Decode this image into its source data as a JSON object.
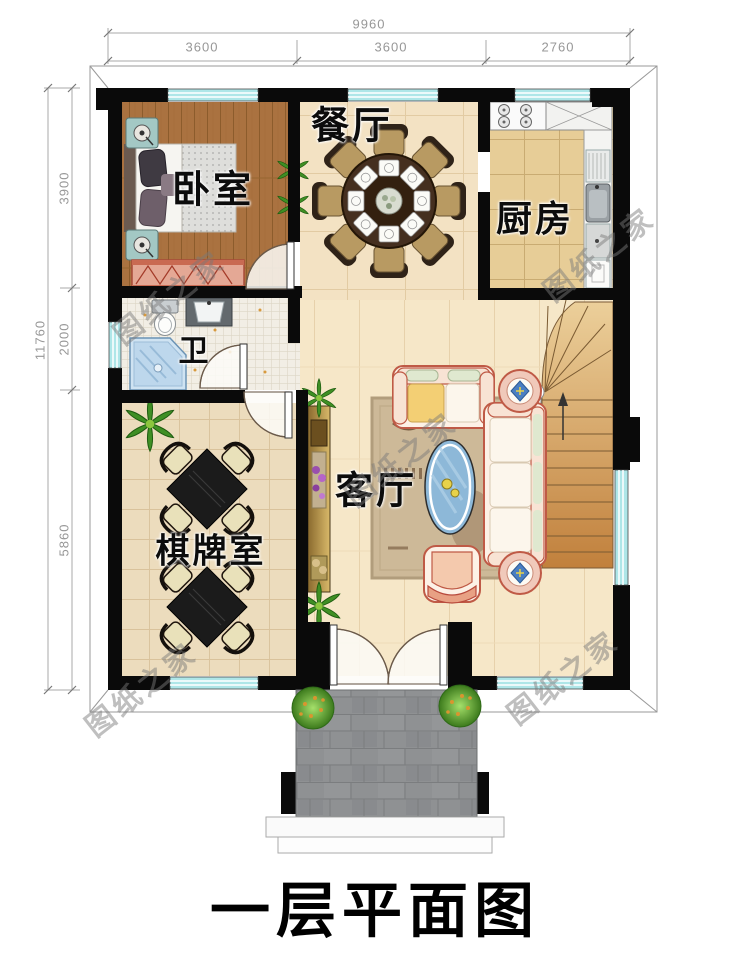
{
  "title": "一层平面图",
  "watermark": "图纸之家",
  "dimensions": {
    "top": {
      "total": "9960",
      "segments": [
        "3600",
        "3600",
        "2760"
      ]
    },
    "left": {
      "total": "11760",
      "segments": [
        "3900",
        "2000",
        "5860"
      ]
    }
  },
  "rooms": {
    "bedroom": "卧室",
    "dining": "餐厅",
    "kitchen": "厨房",
    "bath": "卫",
    "chess": "棋牌室",
    "living": "客厅"
  },
  "colors": {
    "wall": "#0a0a0a",
    "window": "#aee6e8",
    "sofa_outline": "#bf5a46",
    "bedroom_floor": "#aa7240",
    "kitchen_floor": "#e7cd97",
    "living_floor": "#f6e7c8",
    "stairs_wood": "#c1803c",
    "porch_paver": "#8f9193",
    "dimension_text": "#979797"
  }
}
